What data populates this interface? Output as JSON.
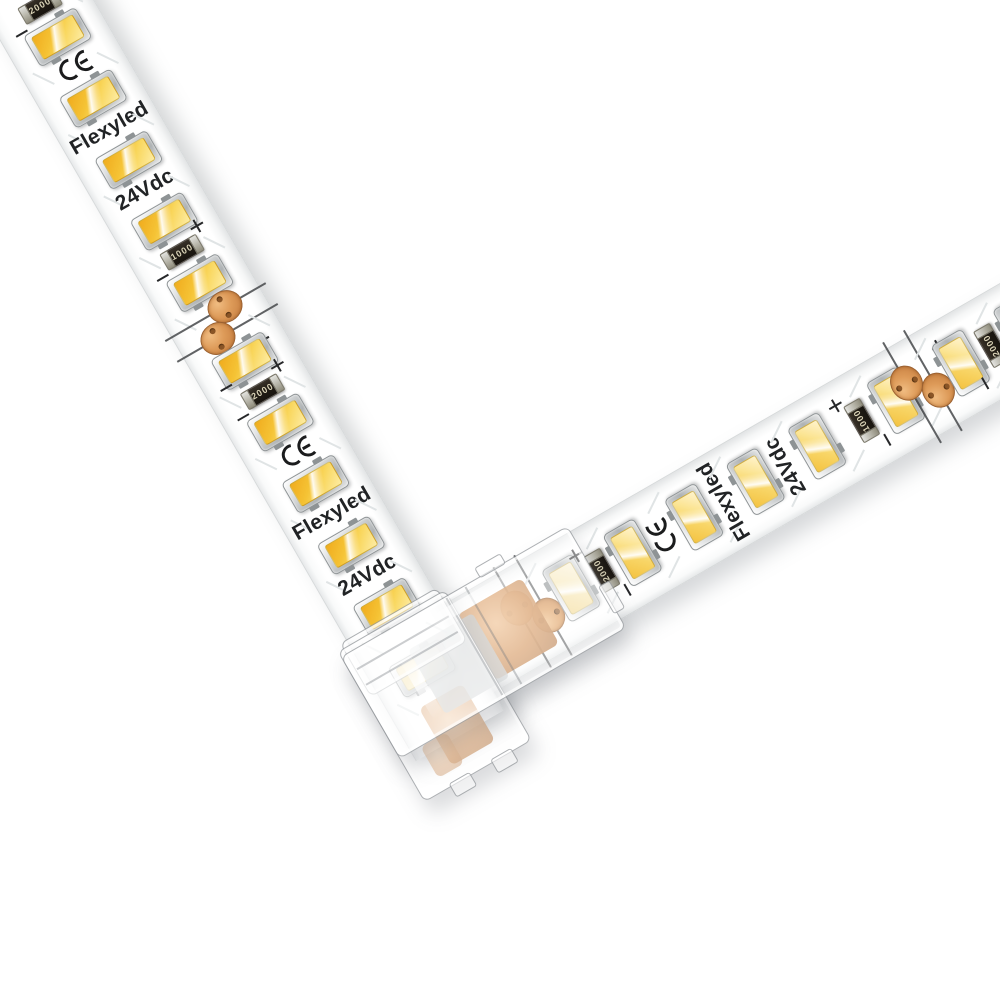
{
  "product": {
    "brand_label": "Flexyled",
    "voltage_label": "24Vdc",
    "certification_mark": "CE",
    "polarity_positive": "+",
    "polarity_negative": "−",
    "resistor_values": [
      "2000",
      "1000"
    ]
  },
  "colors": {
    "background": "#ffffff",
    "pcb_white": "#fdfdfd",
    "led_amber": "#f5c335",
    "led_cream": "#fff3cd",
    "led_frame_silver": "#c9cccd",
    "copper_pad": "#d08a4b",
    "resistor_body": "#221d15",
    "silkscreen_text": "#212325",
    "connector_plastic_edge": "#7a8085"
  },
  "left_strip": {
    "angle_from_horizontal_deg": 60,
    "features": [
      {
        "t": "plus",
        "d": 11
      },
      {
        "t": "res",
        "value": "2000",
        "d": 27
      },
      {
        "t": "minus",
        "d": 43
      },
      {
        "t": "led",
        "d": 63,
        "tone": "rich"
      },
      {
        "t": "ce",
        "d": 98
      },
      {
        "t": "led",
        "d": 134,
        "tone": "rich"
      },
      {
        "t": "brand",
        "d": 169
      },
      {
        "t": "led",
        "d": 205,
        "tone": "rich"
      },
      {
        "t": "volt",
        "d": 240
      },
      {
        "t": "led",
        "d": 276,
        "tone": "rich"
      },
      {
        "t": "plus",
        "d": 297
      },
      {
        "t": "res",
        "value": "1000",
        "d": 311
      },
      {
        "t": "minus",
        "d": 325
      },
      {
        "t": "led",
        "d": 347,
        "tone": "rich"
      },
      {
        "t": "cut",
        "d": 392
      },
      {
        "t": "plus",
        "d": 429
      },
      {
        "t": "led",
        "d": 437,
        "tone": "rich"
      },
      {
        "t": "minus",
        "d": 452
      },
      {
        "t": "plus",
        "d": 458
      },
      {
        "t": "res",
        "value": "2000",
        "d": 472
      },
      {
        "t": "minus",
        "d": 486
      },
      {
        "t": "led",
        "d": 508,
        "tone": "rich"
      },
      {
        "t": "ce",
        "d": 543
      },
      {
        "t": "led",
        "d": 579,
        "tone": "rich"
      },
      {
        "t": "brand",
        "d": 614
      },
      {
        "t": "led",
        "d": 650,
        "tone": "rich"
      },
      {
        "t": "volt",
        "d": 685
      },
      {
        "t": "led",
        "d": 721,
        "tone": "rich"
      },
      {
        "t": "led",
        "d": 792,
        "tone": "pale"
      }
    ]
  },
  "right_strip": {
    "angle_from_horizontal_deg": -30,
    "features": [
      {
        "t": "cut",
        "d": 165
      },
      {
        "t": "led",
        "d": 210,
        "tone": "pale"
      },
      {
        "t": "plus",
        "d": 231
      },
      {
        "t": "res",
        "value": "2000",
        "d": 245
      },
      {
        "t": "minus",
        "d": 259
      },
      {
        "t": "led",
        "d": 281,
        "tone": "soft"
      },
      {
        "t": "ce",
        "d": 316
      },
      {
        "t": "led",
        "d": 352,
        "tone": "soft"
      },
      {
        "t": "brand",
        "d": 387
      },
      {
        "t": "led",
        "d": 423,
        "tone": "soft"
      },
      {
        "t": "volt",
        "d": 458
      },
      {
        "t": "led",
        "d": 494,
        "tone": "soft"
      },
      {
        "t": "plus",
        "d": 531
      },
      {
        "t": "res",
        "value": "1000",
        "d": 545
      },
      {
        "t": "minus",
        "d": 559
      },
      {
        "t": "led",
        "d": 585,
        "tone": "soft"
      },
      {
        "t": "cut",
        "d": 615
      },
      {
        "t": "plus",
        "d": 650
      },
      {
        "t": "led",
        "d": 660,
        "tone": "soft"
      },
      {
        "t": "minus",
        "d": 672
      },
      {
        "t": "res",
        "value": "2000",
        "d": 695
      },
      {
        "t": "led",
        "d": 731,
        "tone": "soft"
      },
      {
        "t": "led",
        "d": 802,
        "tone": "soft"
      }
    ]
  },
  "connector": {
    "shape": "L",
    "transparent": true
  }
}
